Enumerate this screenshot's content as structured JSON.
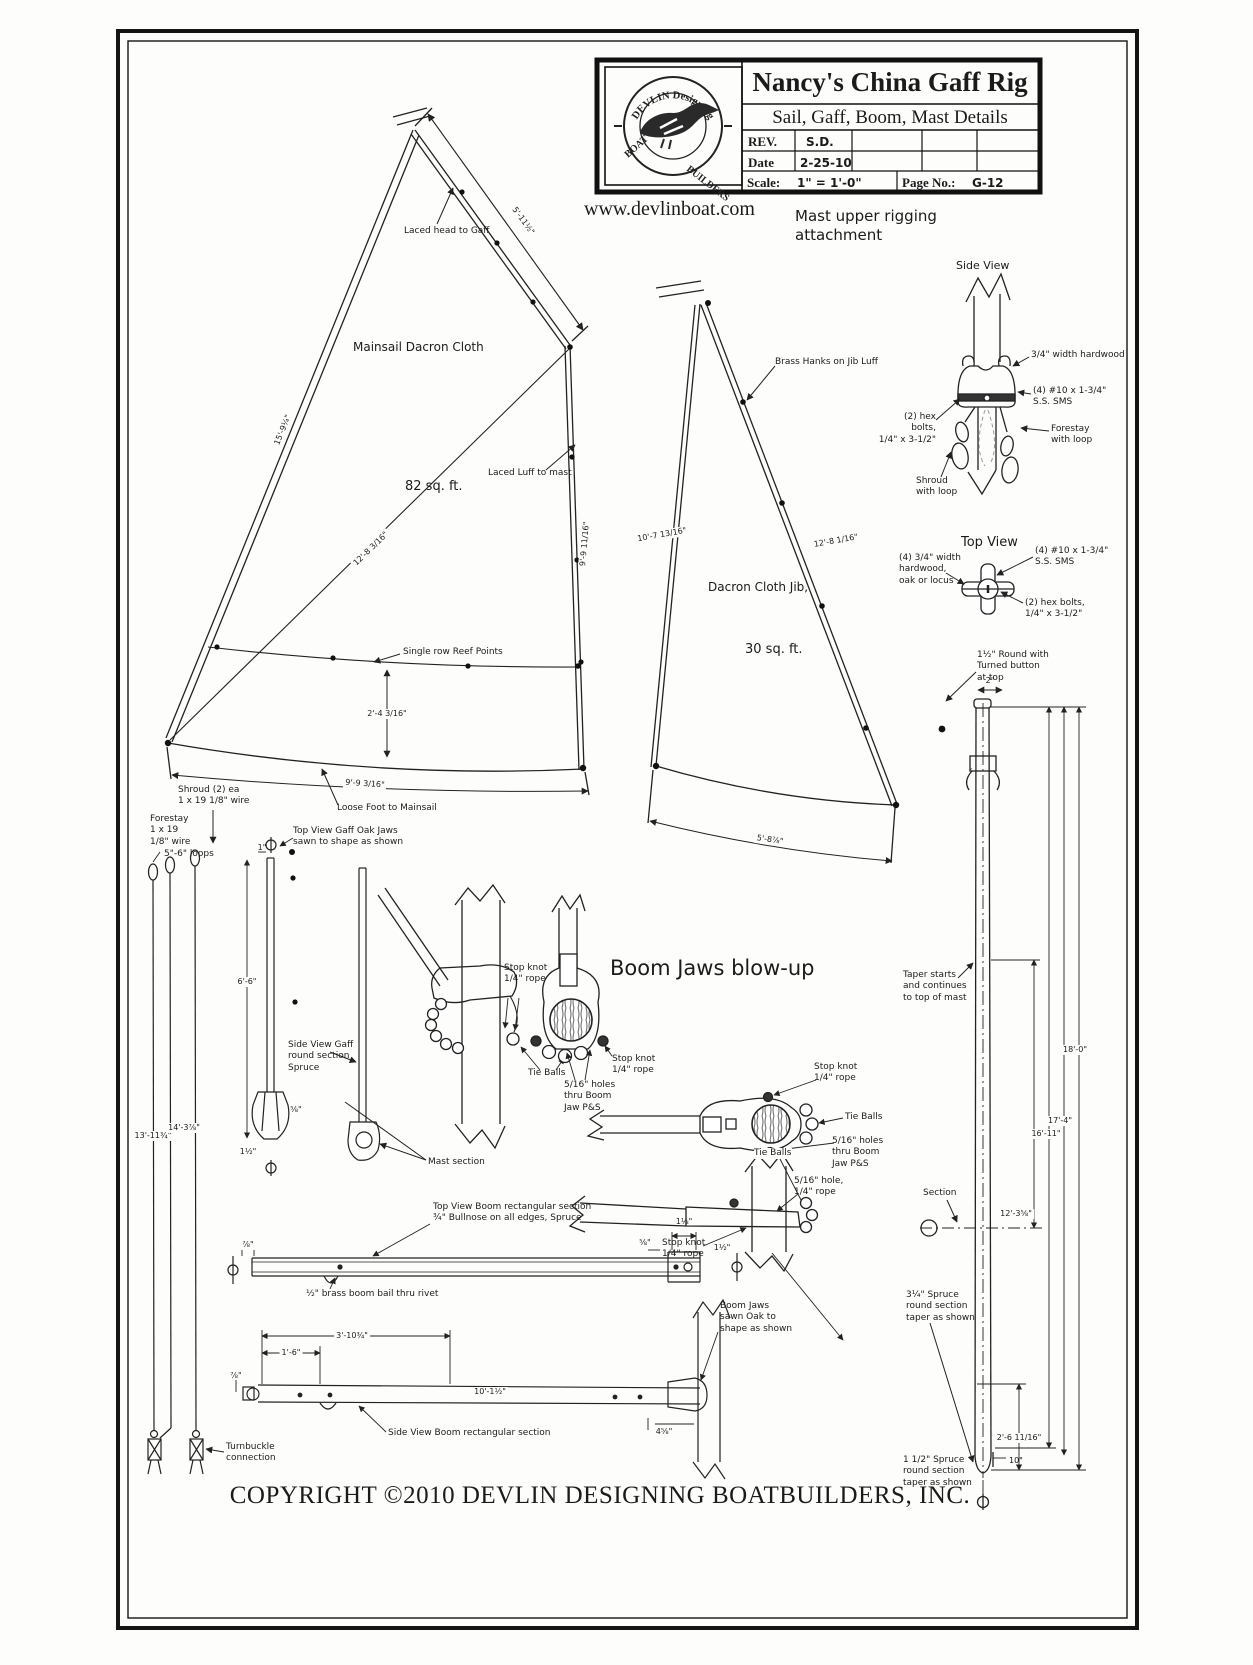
{
  "sheet": {
    "title": "Nancy's China Gaff Rig",
    "subtitle": "Sail, Gaff, Boom, Mast Details",
    "rev_label": "REV.",
    "rev_value": "S.D.",
    "date_label": "Date",
    "date_value": "2-25-10",
    "scale_label": "Scale:",
    "scale_value": "1\" = 1'-0\"",
    "page_label": "Page No.:",
    "page_value": "G-12"
  },
  "logo": {
    "arc_top": "DEVLIN   Designing",
    "boat": "BOAT",
    "builders": "BUILDERS"
  },
  "header": {
    "website": "www.devlinboat.com",
    "rigging_title": "Mast upper rigging\nattachment"
  },
  "views": {
    "side": "Side View",
    "top": "Top View"
  },
  "mainsail": {
    "name": "Mainsail Dacron Cloth",
    "area": "82 sq. ft.",
    "laced_head": "Laced head to Gaff",
    "laced_luff": "Laced Luff to mast",
    "reef": "Single row Reef Points",
    "loose_foot": "Loose Foot to Mainsail",
    "dim_head": "5'-11½\"",
    "dim_leech": "15'-9¼\"",
    "dim_luff": "9'-9 11/16\"",
    "dim_diag": "12'-8 3/16\"",
    "dim_reef": "2'-4 3/16\"",
    "dim_foot": "9'-9 3/16\""
  },
  "jib": {
    "name": "Dacron Cloth Jib,",
    "area": "30 sq. ft.",
    "hanks": "Brass Hanks on Jib Luff",
    "dim_leech": "10'-7 13/16\"",
    "dim_luff": "12'-8 1/16\"",
    "dim_foot": "5'-8⅞\""
  },
  "rigging": {
    "hardwood": "3/4\" width hardwood",
    "sms": "(4) #10 x 1-3/4\"\nS.S. SMS",
    "hex": "(2) hex bolts,\n1/4\" x 3-1/2\"",
    "forestay": "Forestay\nwith loop",
    "shroud": "Shroud\nwith loop",
    "hardwood_top": "(4) 3/4\" width\nhardwood,\noak or locus"
  },
  "stays": {
    "shroud": "Shroud (2) ea\n1 x 19  1/8\" wire",
    "forestay": "Forestay\n1 x 19\n1/8\" wire",
    "loops": "5\"-6\" loops",
    "turnbuckle": "Turnbuckle\nconnection",
    "dim_shroud": "13'-11¾\"",
    "dim_forestay": "14'-3⅞\""
  },
  "mast": {
    "round_top": "1½\" Round with\nTurned button\nat top",
    "dim_top": "2\"",
    "taper": "Taper starts\nand continues\nto top of mast",
    "section": "Section",
    "d18": "18'-0\"",
    "d17": "17'-4\"",
    "d16": "16'-11\"",
    "d12": "12'-3⅝\"",
    "heel": "2'-6 11/16\"",
    "ten": "10\"",
    "spruce_upper": "3¼\" Spruce\nround section\ntaper as shown",
    "spruce_lower": "1 1/2\" Spruce\nround section\ntaper as shown"
  },
  "gaff": {
    "top_view": "Top View Gaff Oak Jaws\nsawn to shape as shown",
    "side_view": "Side View Gaff\nround section\nSpruce",
    "mast_section": "Mast section",
    "d1": "1\"",
    "dlen": "6'-6\"",
    "d2": "1½\"",
    "d3": "⅝\""
  },
  "jaws": {
    "title": "Boom Jaws blow-up",
    "stop_knot": "Stop knot\n1/4\" rope",
    "tie_balls": "Tie Balls",
    "holes": "5/16\" holes\nthru Boom\nJaw P&S",
    "hole": "5/16\" hole,\n1/4\" rope"
  },
  "boom": {
    "top_view": "Top View Boom rectangular section\n¾\" Bullnose on all edges, Spruce",
    "bail": "½\" brass boom bail thru rivet",
    "jaws_label": "Boom Jaws\nsawn Oak to\nshape as shown",
    "side_view": "Side View Boom rectangular section",
    "d_a": "1⅛\"",
    "d_b": "⅝\"",
    "d_c": "1½\"",
    "d_d": "⅞\"",
    "d_e": "3'-10¾\"",
    "d_f": "1'-6\"",
    "d_g": "10'-1½\"",
    "d_h": "4⅝\""
  },
  "footer": {
    "copyright": "COPYRIGHT ©2010 DEVLIN DESIGNING BOATBUILDERS, INC."
  }
}
